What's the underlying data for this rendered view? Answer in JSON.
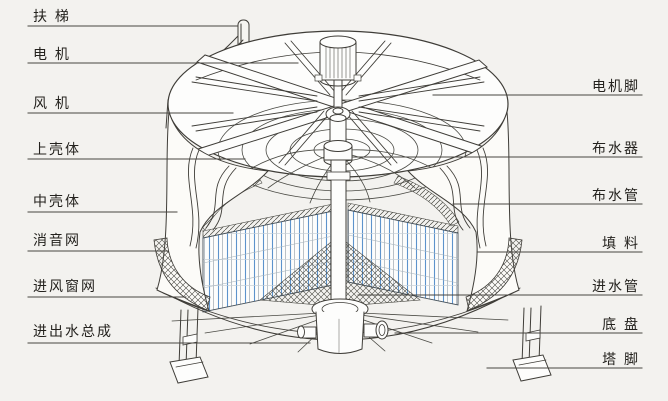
{
  "labels": {
    "left": [
      "扶 梯",
      "电 机",
      "风 机",
      "上壳体",
      "中壳体",
      "消音网",
      "进风窗网",
      "进出水总成"
    ],
    "right": [
      "电机脚",
      "布水器",
      "布水管",
      "填 料",
      "进水管",
      "底 盘",
      "塔 脚"
    ]
  },
  "colors": {
    "paper": "#f3f2ef",
    "line": "#3f3d38",
    "fill_line_blue": "#5d93cc"
  }
}
